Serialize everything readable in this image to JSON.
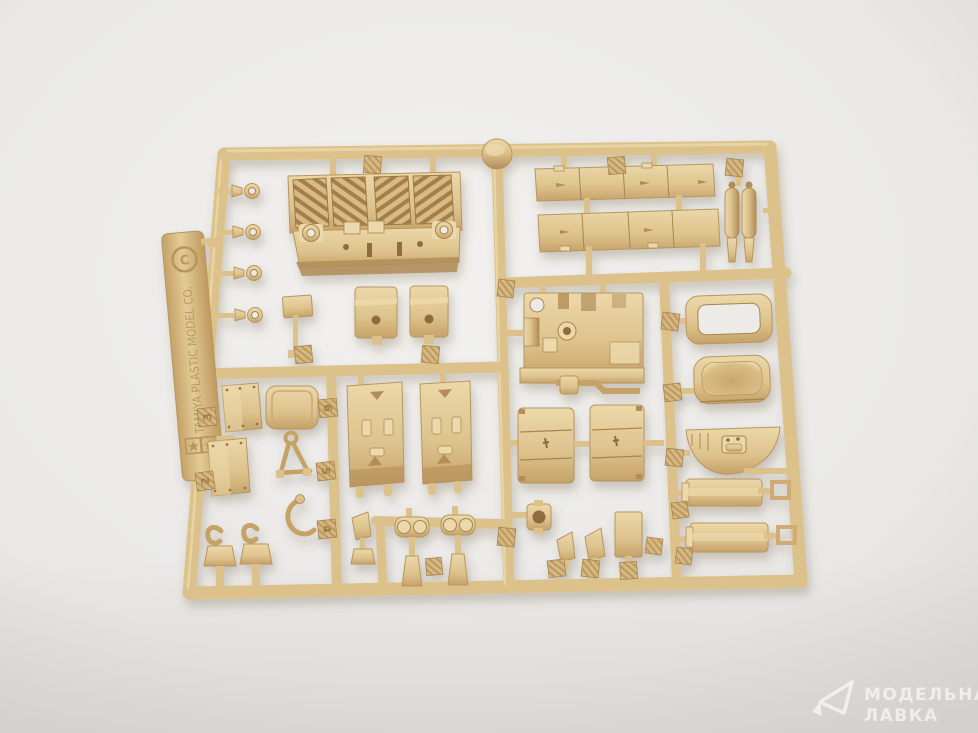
{
  "colors": {
    "bg_center": "#f2f1ef",
    "bg_edge": "#d8d7d5",
    "plastic_base": "#dcc18b",
    "plastic_light": "#ecd9ab",
    "plastic_dark": "#b28d58",
    "plastic_deep": "#8e6c3e",
    "watermark_white": "#ffffff"
  },
  "sprue": {
    "brand_text": "TAMIYA PLASTIC MODEL CO.",
    "copyright_mark": "C",
    "part_tabs": [
      {
        "label": "3"
      },
      {
        "label": "2"
      },
      {
        "label": "6"
      },
      {
        "label": "5"
      },
      {
        "label": "4"
      }
    ]
  },
  "watermark": {
    "icon": "paper-plane-icon",
    "line1": "МОДЕЛЬНАЯ",
    "line2": "ЛАВКА"
  }
}
